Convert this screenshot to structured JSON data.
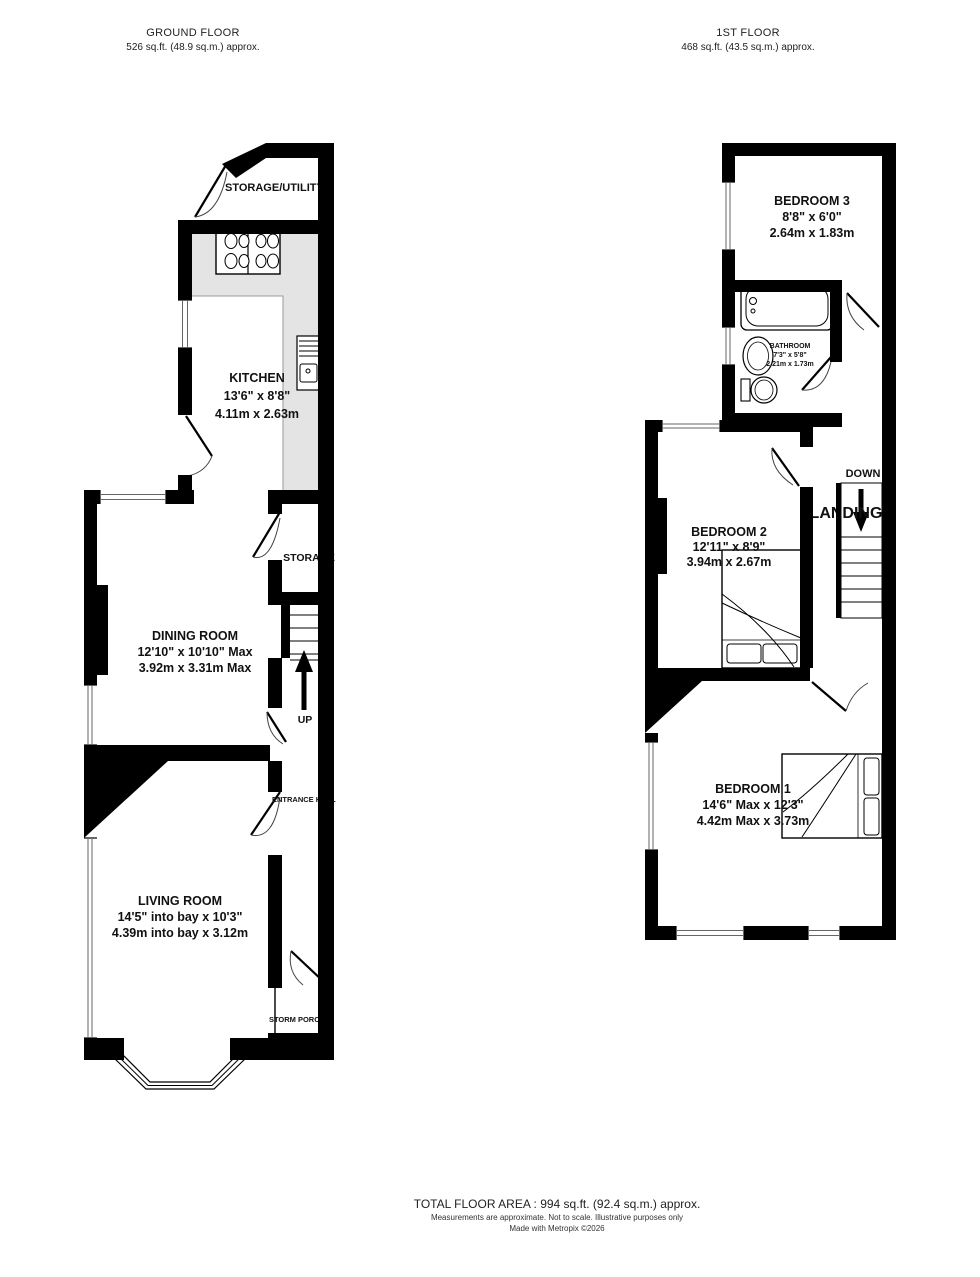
{
  "ground_floor": {
    "title": "GROUND FLOOR",
    "area": "526 sq.ft. (48.9 sq.m.) approx.",
    "rooms": {
      "storage_utility": {
        "name": "STORAGE/UTILITY"
      },
      "kitchen": {
        "name": "KITCHEN",
        "imperial": "13'6\" x 8'8\"",
        "metric": "4.11m x 2.63m"
      },
      "storage": {
        "name": "STORAGE"
      },
      "dining_room": {
        "name": "DINING ROOM",
        "imperial": "12'10\" x 10'10\" Max",
        "metric": "3.92m x 3.31m Max"
      },
      "entrance_hall": {
        "name": "ENTRANCE HALL"
      },
      "living_room": {
        "name": "LIVING ROOM",
        "imperial": "14'5\" into bay x 10'3\"",
        "metric": "4.39m into bay x 3.12m"
      },
      "storm_porch": {
        "name": "STORM PORCH"
      },
      "stairs_label": "UP"
    }
  },
  "first_floor": {
    "title": "1ST FLOOR",
    "area": "468 sq.ft. (43.5 sq.m.) approx.",
    "rooms": {
      "bedroom3": {
        "name": "BEDROOM 3",
        "imperial": "8'8\" x 6'0\"",
        "metric": "2.64m x 1.83m"
      },
      "bathroom": {
        "name": "BATHROOM",
        "imperial": "7'3\" x 5'8\"",
        "metric": "2.21m x 1.73m"
      },
      "landing": {
        "name": "LANDING"
      },
      "bedroom2": {
        "name": "BEDROOM 2",
        "imperial": "12'11\" x 8'9\"",
        "metric": "3.94m x 2.67m"
      },
      "bedroom1": {
        "name": "BEDROOM 1",
        "imperial": "14'6\" Max x 12'3\"",
        "metric": "4.42m Max x 3.73m"
      },
      "stairs_label": "DOWN"
    }
  },
  "footer": {
    "total_area": "TOTAL FLOOR AREA : 994 sq.ft. (92.4 sq.m.) approx.",
    "disclaimer": "Measurements are approximate.  Not to scale.  Illustrative purposes only",
    "credit": "Made with Metropix ©2026"
  },
  "colors": {
    "walls": "#000000",
    "counter": "#e4e4e4",
    "text": "#1a1a1a",
    "background": "#ffffff"
  }
}
